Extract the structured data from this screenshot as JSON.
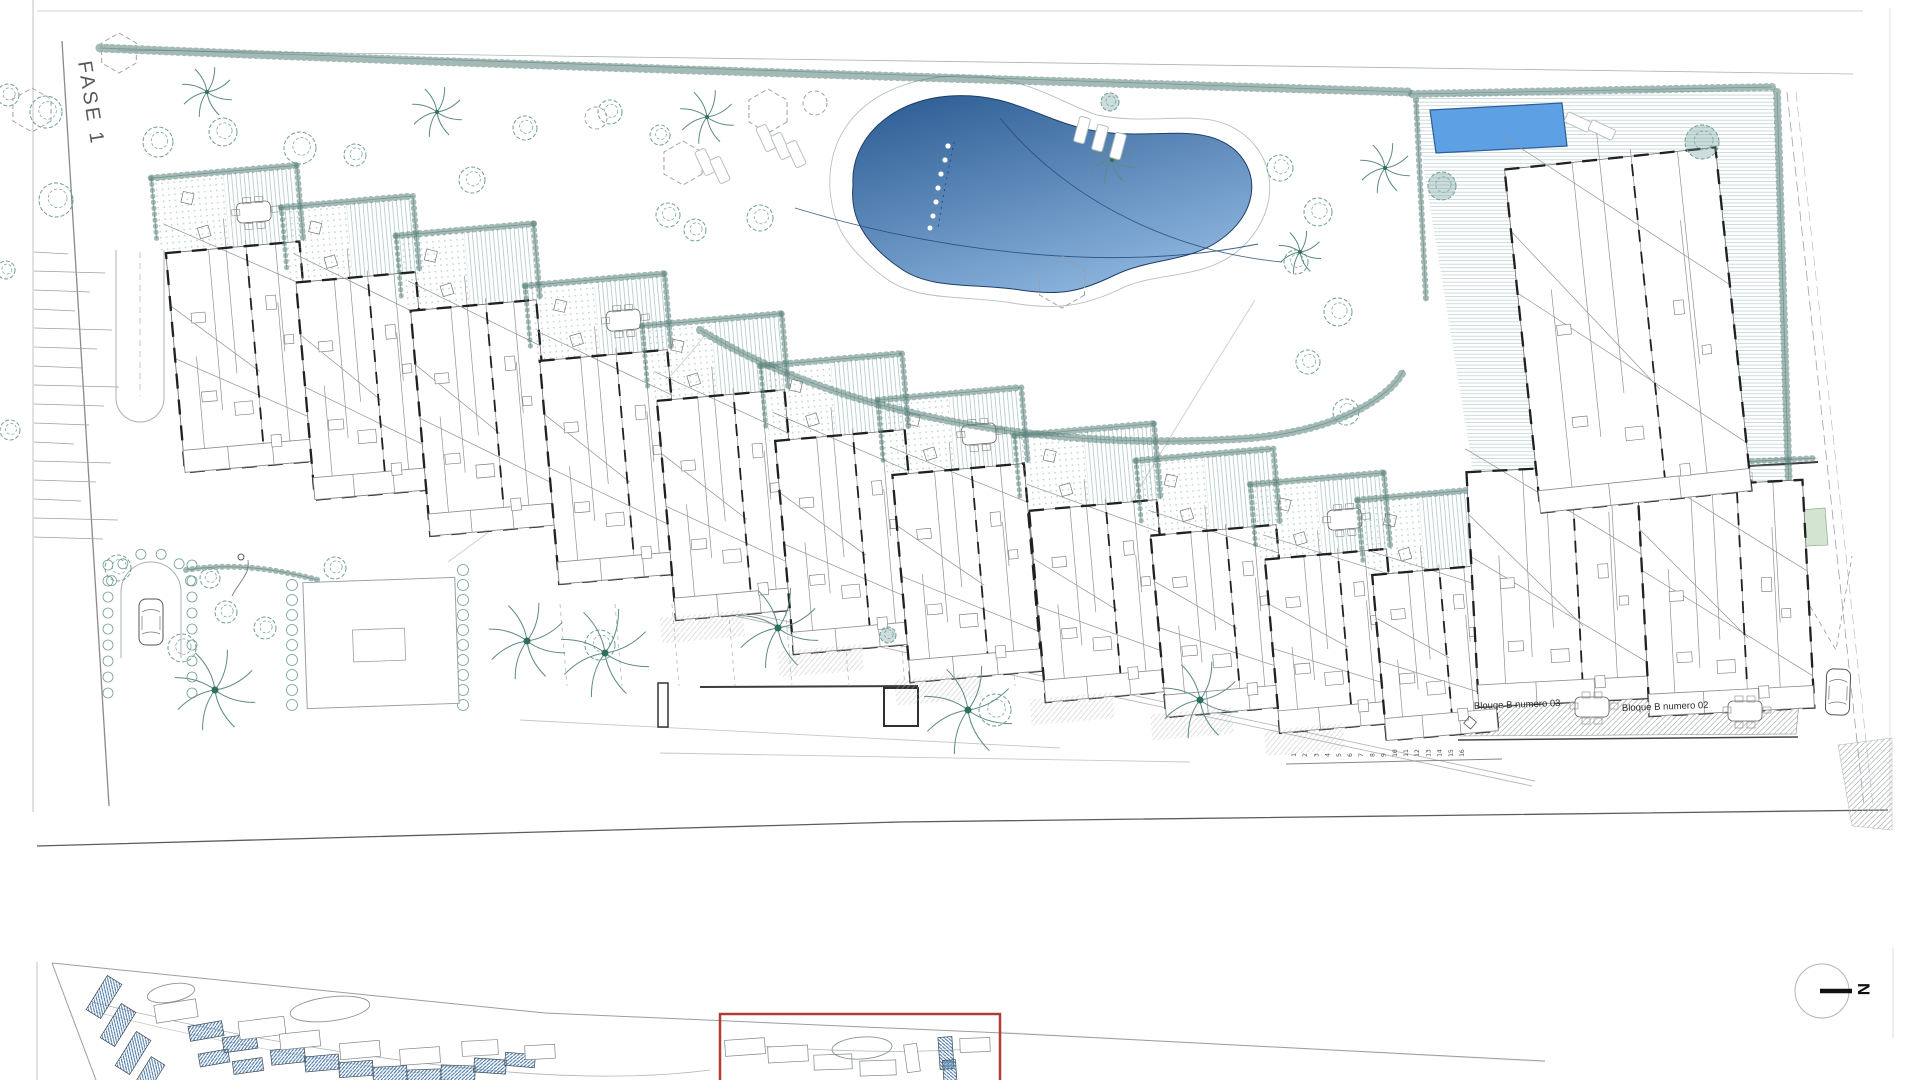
{
  "drawing": {
    "phase_label": "FASE 1",
    "block_label_left": "Blouqe B numero 03",
    "block_label_right": "Bloque B numero 02",
    "north_label": "N",
    "parking_numbers": [
      "1",
      "2",
      "3",
      "4",
      "5",
      "6",
      "7",
      "8",
      "9",
      "10",
      "11",
      "12",
      "13",
      "14",
      "15",
      "16"
    ]
  },
  "colors": {
    "background": "#ffffff",
    "line_gray": "#8f9396",
    "wall_black": "#1e2022",
    "vegetation_teal": "#6f9e98",
    "hedge_teal": "#587f79",
    "pool_dark": "#2f5f96",
    "pool_light": "#8fb7e0",
    "small_pool": "#5ea0e4",
    "overview_roof_blue": "#4a78a8",
    "highlight_red": "#b23b33"
  }
}
